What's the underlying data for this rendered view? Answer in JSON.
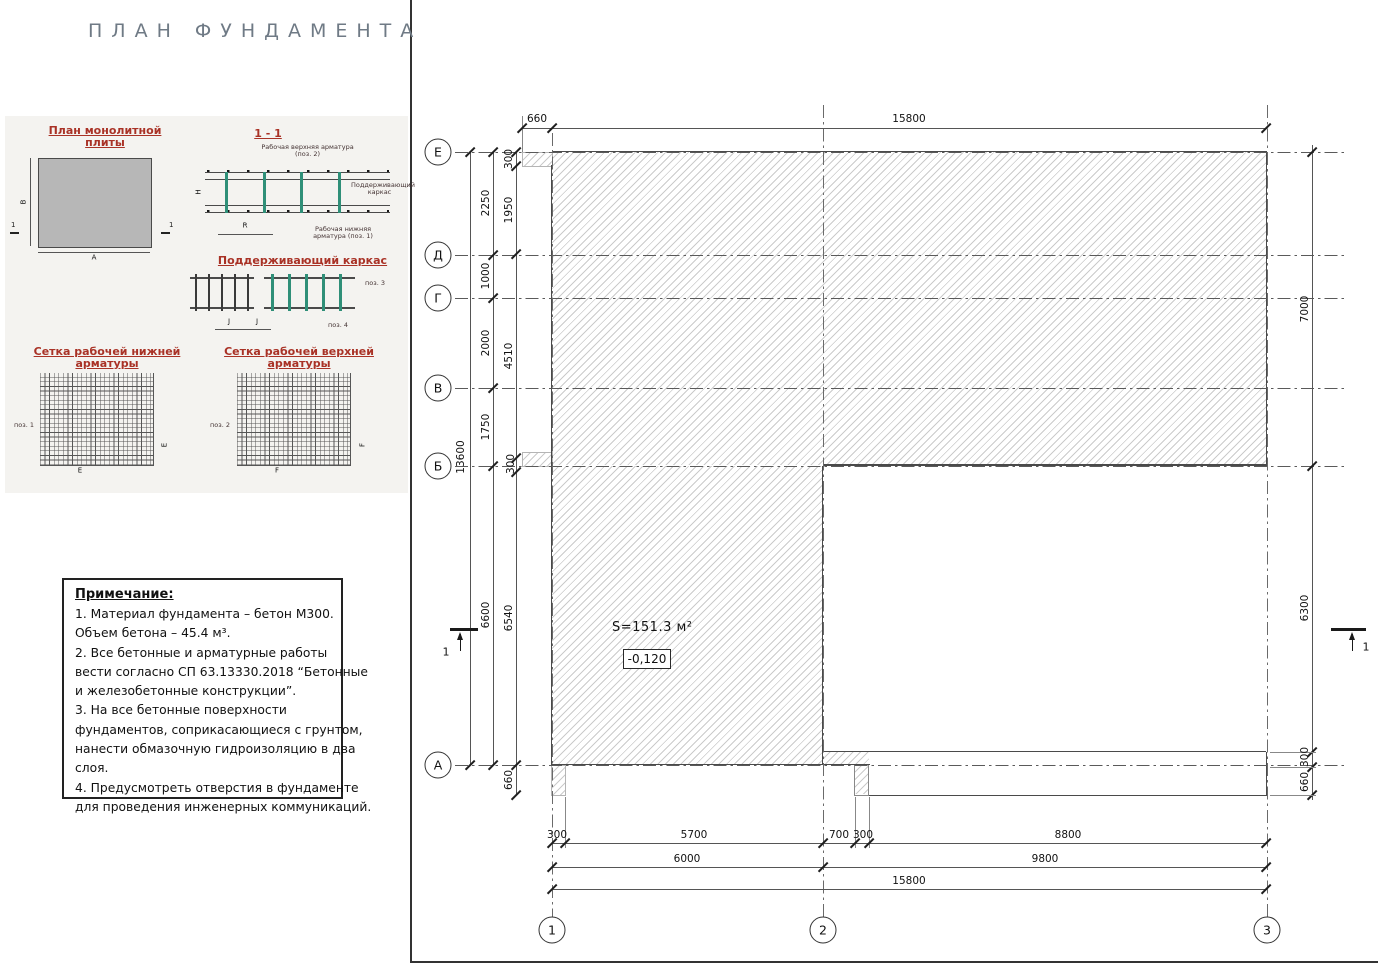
{
  "title": "ПЛАН ФУНДАМЕНТА",
  "inset": {
    "plan_heading": "План монолитной плиты",
    "section_heading": "1 - 1",
    "frame_heading": "Поддерживающий каркас",
    "mesh_bottom_heading": "Сетка рабочей нижней арматуры",
    "mesh_top_heading": "Сетка рабочей верхней арматуры",
    "labels": {
      "top_rebar": "Рабочая верхняя арматура (поз. 2)",
      "support_frame": "Поддерживающий каркас",
      "bottom_rebar": "Рабочая нижняя арматура (поз. 1)",
      "pos1": "поз. 1",
      "pos2": "поз. 2",
      "pos3": "поз. 3",
      "pos4": "поз. 4",
      "dim_a": "A",
      "dim_b": "B",
      "dim_h": "H",
      "dim_r": "R",
      "dim_j": "J",
      "dim_e": "E",
      "dim_f": "F",
      "cut_mark": "1"
    }
  },
  "notes": {
    "title": "Примечание:",
    "lines": [
      "1. Материал фундамента – бетон М300.",
      "Объем бетона –  45.4 м³.",
      "2. Все бетонные и арматурные работы",
      "вести согласно СП 63.13330.2018 “Бетонные",
      "и железобетонные конструкции”.",
      "3. На все бетонные поверхности",
      "фундаментов, соприкасающиеся с грунтом,",
      "нанести обмазочную гидроизоляцию в два",
      "слоя.",
      "4. Предусмотреть отверстия в фундаменте",
      "для проведения инженерных коммуникаций."
    ]
  },
  "plan": {
    "row_axes": [
      "Е",
      "Д",
      "Г",
      "В",
      "Б",
      "А"
    ],
    "col_axes": [
      "1",
      "2",
      "3"
    ],
    "area_label": "S=151.3 м²",
    "elevation": "-0,120",
    "section_mark": "1",
    "dims": {
      "top_660": "660",
      "top_15800": "15800",
      "overall_13600": "13600",
      "e_d": "2250",
      "d_g": "1000",
      "g_v": "2000",
      "v_b": "1750",
      "b_a": "6600",
      "in_300a": "300",
      "in_1950": "1950",
      "in_4510": "4510",
      "in_300b": "300",
      "in_6540": "6540",
      "in_660": "660",
      "r_7000": "7000",
      "r_6300": "6300",
      "r_300": "300",
      "r_660": "660",
      "b1_300a": "300",
      "b1_5700": "5700",
      "b1_700": "700",
      "b1_300b": "300",
      "b1_8800": "8800",
      "b2_6000": "6000",
      "b2_9800": "9800",
      "b3_15800": "15800"
    }
  }
}
